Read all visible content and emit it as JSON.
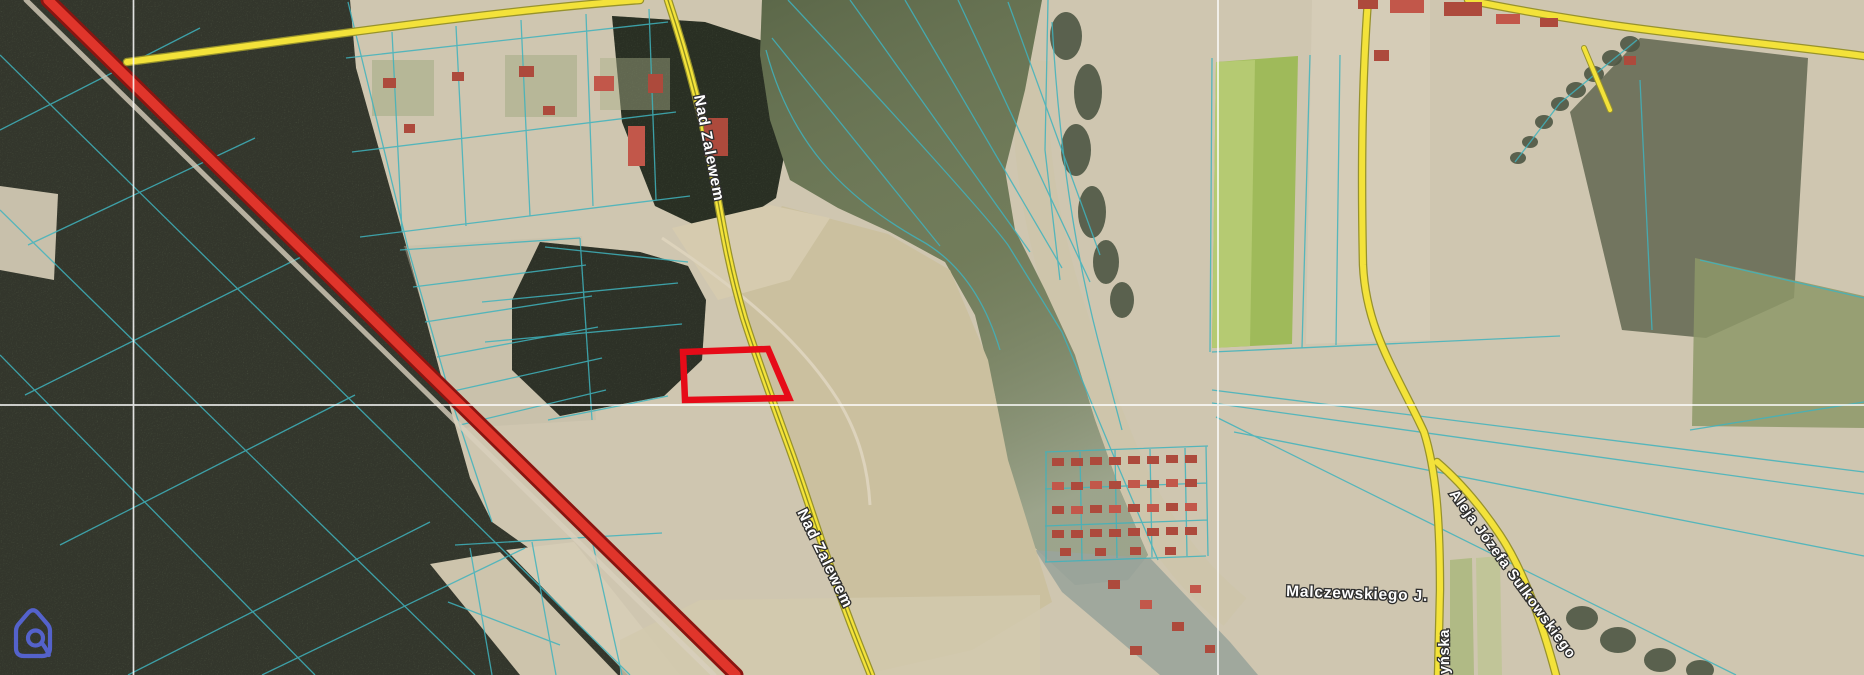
{
  "labels": {
    "street_nad_zalewem_north": "Nad Zalewem",
    "street_nad_zalewem_south": "Nad Zalewem",
    "street_malczewskiego": "Malczewskiego J.",
    "street_aleja_sulkowskiego": "Aleja Józefa Sulkowskiego",
    "street_partial_ynska": "yńska"
  },
  "colors": {
    "railway_red": "#e0352b",
    "railway_edge": "#8a1410",
    "road_yellow": "#f3e23a",
    "road_casing": "#97922c",
    "parcel_cyan": "#3fb3bd",
    "highlight_red": "#e60b18",
    "grid_white": "#ffffff",
    "water_green": "#6d7855",
    "channel_gray": "#9aa49b",
    "building_red": "#ad4a3c",
    "logo_blue": "#5766d9"
  },
  "icons": {
    "logo": "house-loop-logo"
  }
}
